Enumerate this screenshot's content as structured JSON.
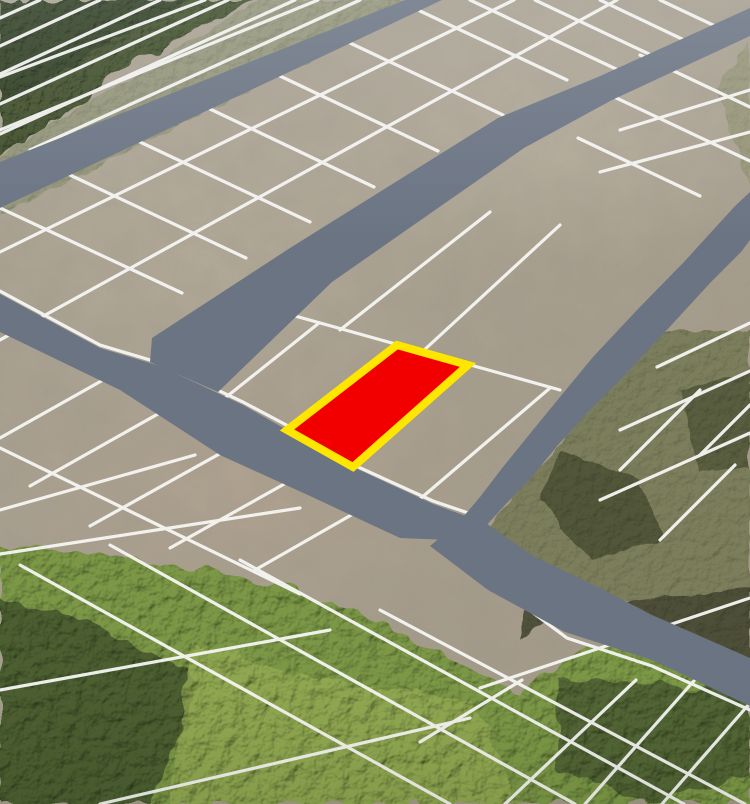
{
  "scene": {
    "type": "aerial-subdivision-plot-map",
    "description": "Oblique aerial photograph of a cleared land subdivision divided into surveyed plots by white boundary lines, with slate-gray overlay roads, forest along the top-left and bottom edges, partially vegetated parcels on the right, and one plot highlighted in red with a yellow border.",
    "highlighted_plot_count": 1
  },
  "palette": {
    "tan_base": "#a89f8e",
    "tan_light": "#bcb29e",
    "tan_pink": "#b5a390",
    "road": "#6b7483",
    "line": "#f6f6f4",
    "forest_dark": "#2e3c23",
    "forest_tl": "#41502c",
    "green_band": "#8f9374",
    "olive": "#767a54",
    "olive_dark": "#4b5134",
    "scrub": "#494c34",
    "forest_bottom": "#7c9847",
    "forest_corner": "#44572e",
    "forest_bright": "#97ad55",
    "forest_br_dark": "#4a5a31",
    "tr_strip": "#8a8f68"
  },
  "highlighted_plot": {
    "points": "287,430 397,345 468,365 353,467",
    "fill": "#f20000",
    "border": "#ffe600",
    "border_width": 8
  },
  "roads": {
    "color": "#6b7483",
    "polygons": {
      "road_top_left": "405,0 442,0 0,208 0,162",
      "main_avenue": "750,8 750,36 612,100 524,148 332,282 218,392 150,362 152,338 290,248 498,118 598,77",
      "front_street": "0,294 100,348 160,366 243,405 287,430 353,467 433,504 482,522 472,541 400,538 310,496 220,455 120,390 0,332",
      "cross_street": "750,192 750,240 741,252 711,282 665,332 621,379 588,412 558,445 530,479 505,505 483,529 462,550 444,542 458,523 480,497 503,467 533,430 560,397 593,357 637,310 683,263 735,206",
      "lower_road": "470,512 533,556 600,588 652,615 750,658 750,706 652,660 565,632 488,590 430,546"
    }
  },
  "grid": {
    "line_color": "#f6f6f4",
    "line_width": 3.2,
    "segments": [
      [
        40,
        0,
        0,
        18
      ],
      [
        100,
        0,
        0,
        46
      ],
      [
        160,
        0,
        0,
        74
      ],
      [
        228,
        0,
        0,
        104
      ],
      [
        295,
        0,
        0,
        134
      ],
      [
        360,
        0,
        30,
        150
      ],
      [
        0,
        77,
        205,
        0
      ],
      [
        0,
        130,
        318,
        0
      ],
      [
        0,
        252,
        514,
        0
      ],
      [
        0,
        340,
        617,
        0
      ],
      [
        0,
        208,
        182,
        293
      ],
      [
        70,
        175,
        246,
        258
      ],
      [
        140,
        142,
        310,
        222
      ],
      [
        210,
        109,
        374,
        187
      ],
      [
        280,
        76,
        438,
        151
      ],
      [
        350,
        43,
        503,
        115
      ],
      [
        420,
        11,
        567,
        80
      ],
      [
        470,
        0,
        616,
        69
      ],
      [
        535,
        0,
        649,
        54
      ],
      [
        600,
        0,
        682,
        39
      ],
      [
        660,
        0,
        713,
        25
      ],
      [
        245,
        302,
        560,
        390
      ],
      [
        160,
        366,
        245,
        302
      ],
      [
        225,
        398,
        319,
        323
      ],
      [
        420,
        499,
        550,
        388
      ],
      [
        280,
        312,
        420,
        200
      ],
      [
        340,
        330,
        490,
        212
      ],
      [
        422,
        352,
        560,
        225
      ],
      [
        640,
        55,
        750,
        107
      ],
      [
        610,
        95,
        750,
        161
      ],
      [
        578,
        138,
        700,
        196
      ],
      [
        620,
        130,
        750,
        90
      ],
      [
        600,
        172,
        750,
        132
      ],
      [
        657,
        367,
        750,
        323
      ],
      [
        620,
        430,
        750,
        371
      ],
      [
        600,
        500,
        750,
        433
      ],
      [
        620,
        470,
        700,
        390
      ],
      [
        660,
        540,
        735,
        465
      ],
      [
        700,
        455,
        750,
        405
      ],
      [
        103,
        380,
        0,
        438
      ],
      [
        165,
        410,
        30,
        486
      ],
      [
        230,
        448,
        90,
        526
      ],
      [
        295,
        478,
        170,
        548
      ],
      [
        360,
        510,
        255,
        570
      ],
      [
        0,
        510,
        195,
        455
      ],
      [
        0,
        448,
        300,
        594
      ],
      [
        20,
        565,
        450,
        804
      ],
      [
        110,
        545,
        575,
        804
      ],
      [
        240,
        560,
        684,
        804
      ],
      [
        380,
        610,
        745,
        804
      ],
      [
        0,
        554,
        300,
        508
      ],
      [
        0,
        690,
        330,
        630
      ],
      [
        100,
        804,
        470,
        718
      ],
      [
        420,
        742,
        522,
        680
      ],
      [
        505,
        804,
        636,
        680
      ],
      [
        585,
        804,
        700,
        674
      ],
      [
        662,
        804,
        750,
        703
      ],
      [
        480,
        688,
        750,
        598
      ]
    ],
    "edge_polylines": [
      "0,291 100,345 160,363 243,402 290,427 356,466 433,501 480,517",
      "470,566 567,638 652,666 750,710"
    ]
  }
}
